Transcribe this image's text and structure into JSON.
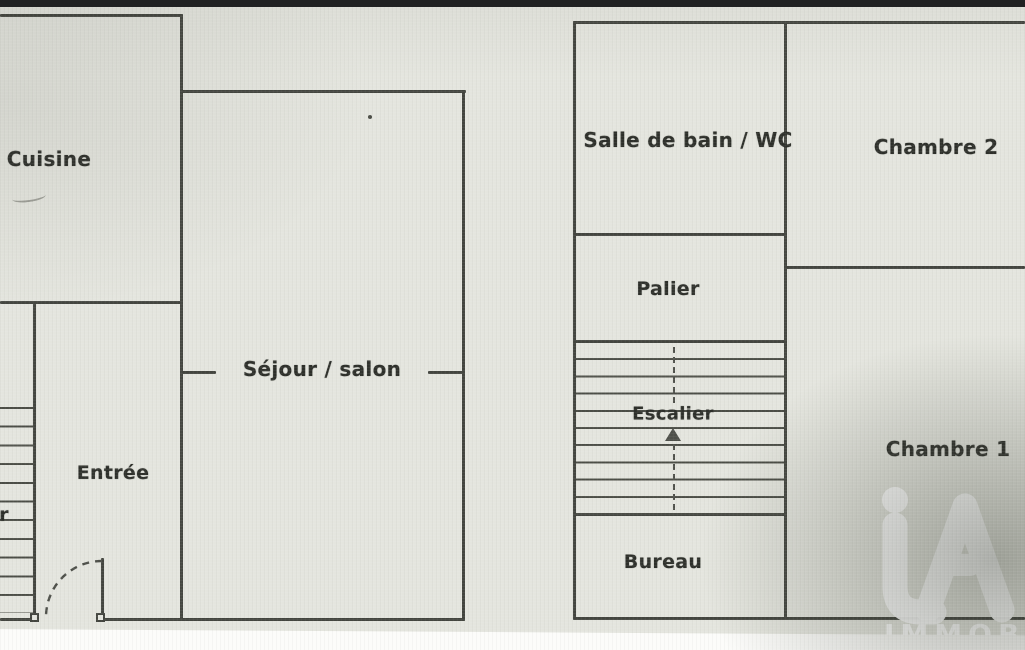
{
  "photo": {
    "background_color": "#e4e5de",
    "wall_color": "#43453f",
    "top_bar_color": "#202122",
    "bottom_strip_color": "#fcfcfa"
  },
  "ground_floor": {
    "cuisine": "Cuisine",
    "sejour_salon": "Séjour / salon",
    "entree": "Entrée",
    "stair_label_fragment": "r"
  },
  "upper_floor": {
    "salle_de_bain_wc": "Salle de bain / WC",
    "chambre_2": "Chambre 2",
    "palier": "Palier",
    "escalier": "Escalier",
    "chambre_1": "Chambre 1",
    "bureau": "Bureau"
  },
  "watermark": {
    "monogram": "iA",
    "wordmark": "IMMOB"
  }
}
